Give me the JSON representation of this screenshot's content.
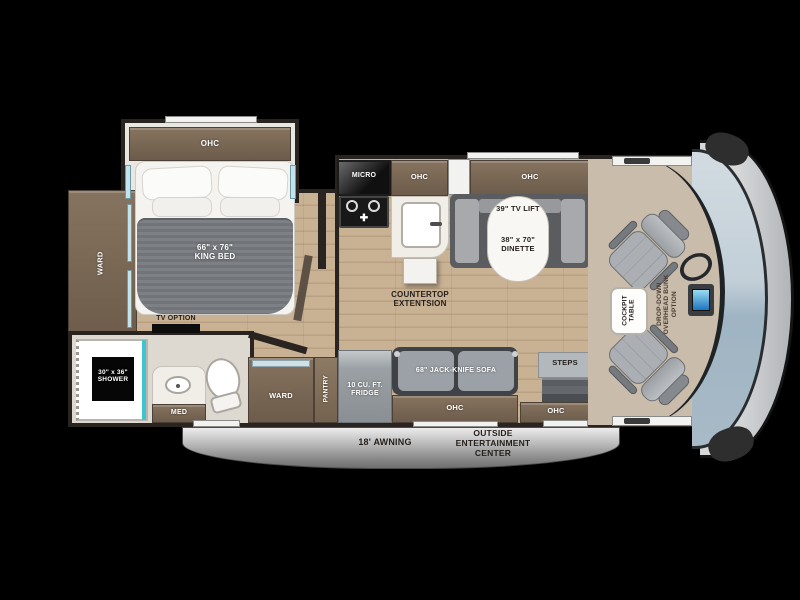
{
  "title": "Class C motorhome floor plan",
  "colors": {
    "background": "#000000",
    "wall": "#29241f",
    "cabinet_wood": "#7a6854",
    "floor_wood": "#c4ad8f",
    "furniture_gray": "#9ba1a6",
    "windshield_blue": "#a9bcca",
    "front_cap_gray": "#c3c6c9",
    "shower_accent_teal": "#3fc4d1",
    "monitor_blue": "#2f9fe0",
    "awning_silver": "#b5b5b5"
  },
  "labels": {
    "bedroom": {
      "ohc": "OHC",
      "bed": "66\" x 76\"\nKING BED",
      "ward": "WARD",
      "tv_option": "TV OPTION"
    },
    "kitchen": {
      "micro": "MICRO",
      "ohc": "OHC",
      "countertop": "COUNTERTOP\nEXTENTSION"
    },
    "dinette": {
      "ohc": "OHC",
      "tv_lift": "39\" TV LIFT",
      "size": "38\" x 70\"\nDINETTE"
    },
    "bath": {
      "shower": "30\" x 36\"\nSHOWER",
      "med": "MED"
    },
    "hall": {
      "ward": "WARD",
      "pantry": "PANTRY",
      "fridge": "10 CU. FT.\nFRIDGE"
    },
    "living": {
      "sofa": "68\" JACK-KNIFE SOFA",
      "ohc": "OHC"
    },
    "entry": {
      "steps": "STEPS",
      "ohc": "OHC"
    },
    "cab": {
      "cockpit_table": "COCKPIT\nTABLE",
      "bunk_option": "DROP-DOWN\nOVERHEAD BUNK\nOPTION"
    },
    "exterior": {
      "awning": "18' AWNING",
      "entertainment": "OUTSIDE\nENTERTAINMENT\nCENTER"
    }
  }
}
